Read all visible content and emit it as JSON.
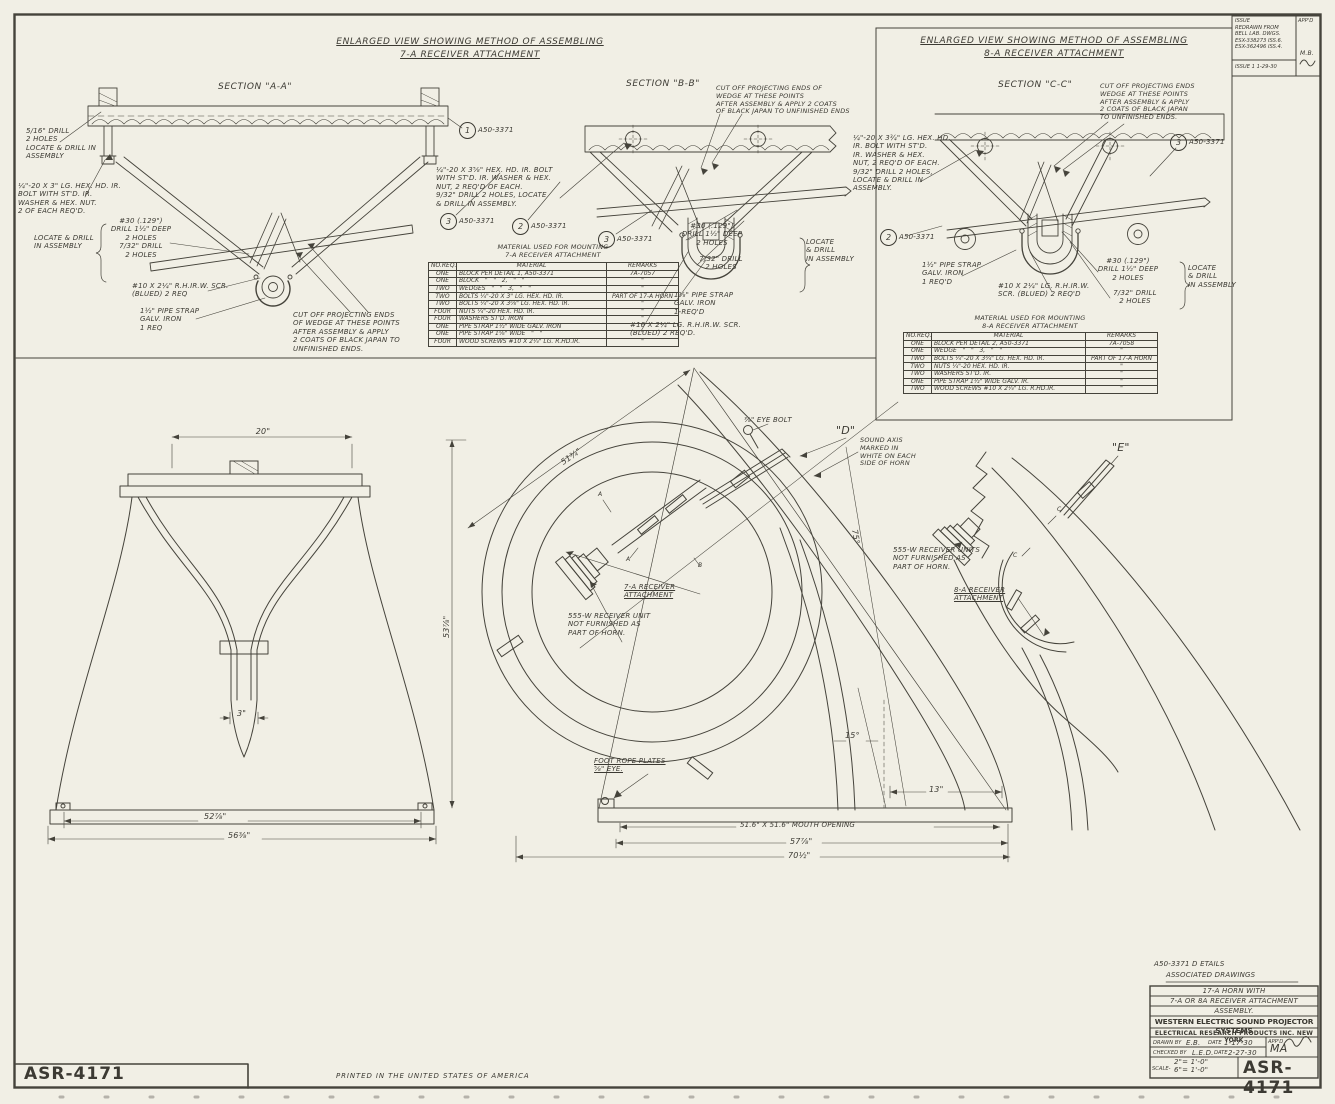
{
  "colors": {
    "paper": "#f1efe5",
    "ink": "#45433b"
  },
  "page": {
    "sheet_no": "ASR-4171",
    "printed_note": "PRINTED IN THE UNITED STATES OF AMERICA"
  },
  "revision_box": {
    "appd_header": "APP'D",
    "notes": "ISSUE\nREDRAWN FROM\nBELL LAB. DWGS.\nESX-338273 ISS.6.\nESX-362496 ISS.4.",
    "issue_line": "ISSUE 1   1-29-30",
    "initials": "M.B."
  },
  "view7a": {
    "title_line1": "ENLARGED VIEW SHOWING METHOD OF ASSEMBLING",
    "title_line2": "7-A RECEIVER ATTACHMENT",
    "section_aa": "SECTION \"A-A\"",
    "section_bb": "SECTION \"B-B\"",
    "drill_note": "5/16\" DRILL\n2 HOLES\nLOCATE & DRILL IN\nASSEMBLY",
    "bolt_note": "¼\"-20 X 3\" LG. HEX. HD. IR.\nBOLT WITH ST'D. IR.\nWASHER & HEX. NUT.\n2 OF EACH REQ'D.",
    "locate_note": "LOCATE & DRILL\nIN ASSEMBLY",
    "drill30_note": "#30 (.129\")\nDRILL 1½\" DEEP\n2 HOLES\n7/32\" DRILL\n2 HOLES",
    "screw_note": "#10 X 2¼\" R.H.IR.W. SCR.\n(BLUED) 2 REQ",
    "strap_note": "1½\" PIPE STRAP\nGALV. IRON\n1 REQ",
    "cutoff_note": "CUT OFF PROJECTING ENDS\nOF WEDGE AT THESE POINTS\nAFTER ASSEMBLY & APPLY\n2 COATS OF BLACK JAPAN TO\nUNFINISHED ENDS.",
    "bb_cutoff_note": "CUT OFF PROJECTING ENDS OF\nWEDGE AT THESE POINTS\nAFTER ASSEMBLY & APPLY 2 COATS\nOF BLACK JAPAN TO UNFINISHED ENDS",
    "bb_bolt_note": "¼\"-20 X 3⅝\" HEX. HD. IR. BOLT\nWITH ST'D. IR. WASHER & HEX.\nNUT, 2 REQ'D OF EACH.\n9/32\" DRILL 2 HOLES, LOCATE\n& DRILL IN ASSEMBLY.",
    "bb_drill30_note": "#30 (.129\")\nDRILL 1½\" DEEP\n2 HOLES",
    "bb_drill732_note": "7/32\" DRILL\n2 HOLES",
    "bb_locate_note": "LOCATE\n& DRILL\nIN ASSEMBLY",
    "bb_strap_note": "1⅝\" PIPE STRAP\nGALV. IRON\n1-REQ'D",
    "bb_screw_note": "#10 X 2¼\" LG. R.H.IR.W. SCR.\n(BLUED) 2 REQ'D.",
    "balloon1": "1",
    "balloon2": "2",
    "balloon3": "3",
    "part_ref": "A50-3371"
  },
  "table7a": {
    "title": "MATERIAL USED FOR MOUNTING\n7-A RECEIVER ATTACHMENT",
    "headers": [
      "NO.REQ.",
      "MATERIAL",
      "REMARKS"
    ],
    "rows": [
      [
        "ONE",
        "BLOCK PER DETAIL 1, A50-3371",
        "7A-7057"
      ],
      [
        "ONE",
        "BLOCK   \"   \"   2,   \"   \"",
        "\""
      ],
      [
        "TWO",
        "WEDGES   \"   \"   3,   \"   \"",
        "\""
      ],
      [
        "TWO",
        "BOLTS ¼\"-20 X 3\" LG. HEX. HD. IR.",
        "PART OF 17-A HORN"
      ],
      [
        "TWO",
        "BOLTS ¼\"-20 X 3⅝\" LG. HEX. HD. IR.",
        "\""
      ],
      [
        "FOUR",
        "NUTS ¼\"-20 HEX. HD. IR.",
        "\""
      ],
      [
        "FOUR",
        "WASHERS ST'D. IRON",
        "\""
      ],
      [
        "ONE",
        "PIPE STRAP 1½\" WIDE GALV. IRON",
        "\""
      ],
      [
        "ONE",
        "PIPE STRAP 1⅝\" WIDE   \"   \"",
        "\""
      ],
      [
        "FOUR",
        "WOOD SCREWS #10 X 2¼\" LG. R.HD.IR.",
        "\""
      ]
    ]
  },
  "view8a": {
    "title_line1": "ENLARGED VIEW SHOWING METHOD OF ASSEMBLING",
    "title_line2": "8-A RECEIVER ATTACHMENT",
    "section_cc": "SECTION \"C-C\"",
    "cutoff_note": "CUT OFF PROJECTING ENDS\nWEDGE AT THESE POINTS\nAFTER ASSEMBLY & APPLY\n2 COATS OF BLACK JAPAN\nTO UNFINISHED ENDS.",
    "bolt_note": "¼\"-20 X 3¾\" LG. HEX. HD.\nIR. BOLT WITH ST'D.\nIR. WASHER & HEX.\nNUT, 2 REQ'D OF EACH.\n9/32\" DRILL 2 HOLES,\nLOCATE & DRILL IN\nASSEMBLY.",
    "strap_note": "1½\" PIPE STRAP\nGALV. IRON\n1 REQ'D",
    "screw_note": "#10 X 2¼\" LG. R.H.IR.W.\nSCR. (BLUED) 2 REQ'D",
    "drill30_note": "#30 (.129\")\nDRILL 1½\" DEEP\n2 HOLES",
    "drill732_note": "7/32\" DRILL\n2 HOLES",
    "locate_note": "LOCATE\n& DRILL\nIN ASSEMBLY",
    "balloon2": "2",
    "balloon3": "3",
    "part_ref": "A50-3371"
  },
  "table8a": {
    "title": "MATERIAL USED FOR MOUNTING\n8-A RECEIVER ATTACHMENT",
    "headers": [
      "NO.REQ.",
      "MATERIAL",
      "REMARKS"
    ],
    "rows": [
      [
        "ONE",
        "BLOCK PER DETAIL 2, A50-3371",
        "7A-7058"
      ],
      [
        "ONE",
        "WEDGE   \"   \"   3,   \"   \"",
        "\""
      ],
      [
        "TWO",
        "BOLTS ¼\"-20 X 3¾\" LG. HEX. HD. IR.",
        "PART OF 17-A HORN"
      ],
      [
        "TWO",
        "NUTS ¼\"-20 HEX. HD. IR.",
        "\""
      ],
      [
        "TWO",
        "WASHERS ST'D. IR.",
        "\""
      ],
      [
        "ONE",
        "PIPE STRAP 1½\" WIDE GALV. IR.",
        "\""
      ],
      [
        "TWO",
        "WOOD SCREWS #10 X 2¼\" LG. R.HD.IR.",
        "\""
      ]
    ]
  },
  "main": {
    "dim_20": "20\"",
    "dim_3": "3\"",
    "dim_52": "52⅞\"",
    "dim_56": "56⅜\"",
    "dim_53": "53⅞\"",
    "dim_51": "51¾\"",
    "eye_bolt": "⅜\" EYE BOLT",
    "d": "\"D\"",
    "e": "\"E\"",
    "sound_axis": "SOUND AXIS\nMARKED IN\nWHITE ON EACH\nSIDE OF HORN",
    "deg75": "75°",
    "deg15": "15°",
    "dim_13": "13\"",
    "attach7": "7-A RECEIVER\nATTACHMENT",
    "recv1": "555-W RECEIVER UNIT\nNOT FURNISHED AS\nPART OF HORN.",
    "recv2": "555-W RECEIVER UNITS\nNOT FURNISHED AS\nPART OF HORN.",
    "attach8": "8-A RECEIVER\nATTACHMENT",
    "foot_rope": "FOOT ROPE PLATES\n⅝\" EYE.",
    "mouth": "51.6\" X 51.6\" MOUTH OPENING",
    "dim_57": "57⅞\"",
    "dim_70": "70½\"",
    "sec_a": "A",
    "sec_b": "B",
    "sec_c": "C"
  },
  "title_block": {
    "assoc_line1": "A50-3371 D ETAILS",
    "assoc_line2": "ASSOCIATED DRAWINGS",
    "row1": "17-A HORN WITH",
    "row2": "7-A OR 8A RECEIVER ATTACHMENT",
    "row3": "ASSEMBLY.",
    "company": "WESTERN ELECTRIC SOUND PROJECTOR SYSTEMS",
    "division": "ELECTRICAL RESEARCH PRODUCTS INC. NEW YORK",
    "drawn_label": "DRAWN BY",
    "drawn": "E.B.",
    "date_label": "DATE",
    "drawn_date": "1-17-30",
    "checked_label": "CHECKED BY",
    "checked": "L.E.D.",
    "checked_date": "2-27-30",
    "appd_label": "APP'D",
    "appd_sig": "MA",
    "scale_label": "SCALE-",
    "scale": "2\"= 1'-0\"\n6\"= 1'-0\"",
    "number": "ASR-4171"
  }
}
